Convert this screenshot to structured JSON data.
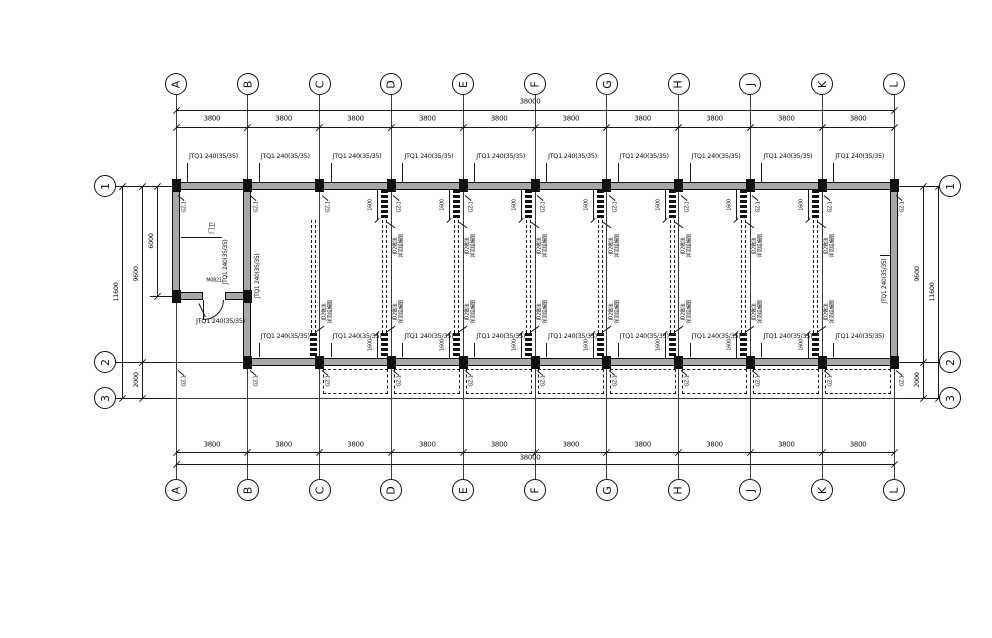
{
  "drawing": {
    "title": "wall layout plan",
    "grid_cols": [
      "A",
      "B",
      "C",
      "D",
      "E",
      "F",
      "G",
      "H",
      "J",
      "K",
      "L"
    ],
    "grid_rows": [
      "1",
      "2",
      "3"
    ],
    "dims": {
      "bay": "3800",
      "total_width": "38000",
      "row1_row2": "9600",
      "row2_row3": "2000",
      "total_height": "11600",
      "room_depth": "6000",
      "duct_offset": "1600"
    },
    "labels": {
      "wall": "JTQ1 240(35/35)",
      "column_tag": "GZ-1",
      "door": "M0821",
      "room": "门卫",
      "duct_line1": "JD2做法",
      "duct_line2": "详见结施图"
    },
    "colors": {
      "line": "#1a1a1a",
      "wall_fill": "#a8a8a8",
      "background": "#ffffff"
    }
  }
}
